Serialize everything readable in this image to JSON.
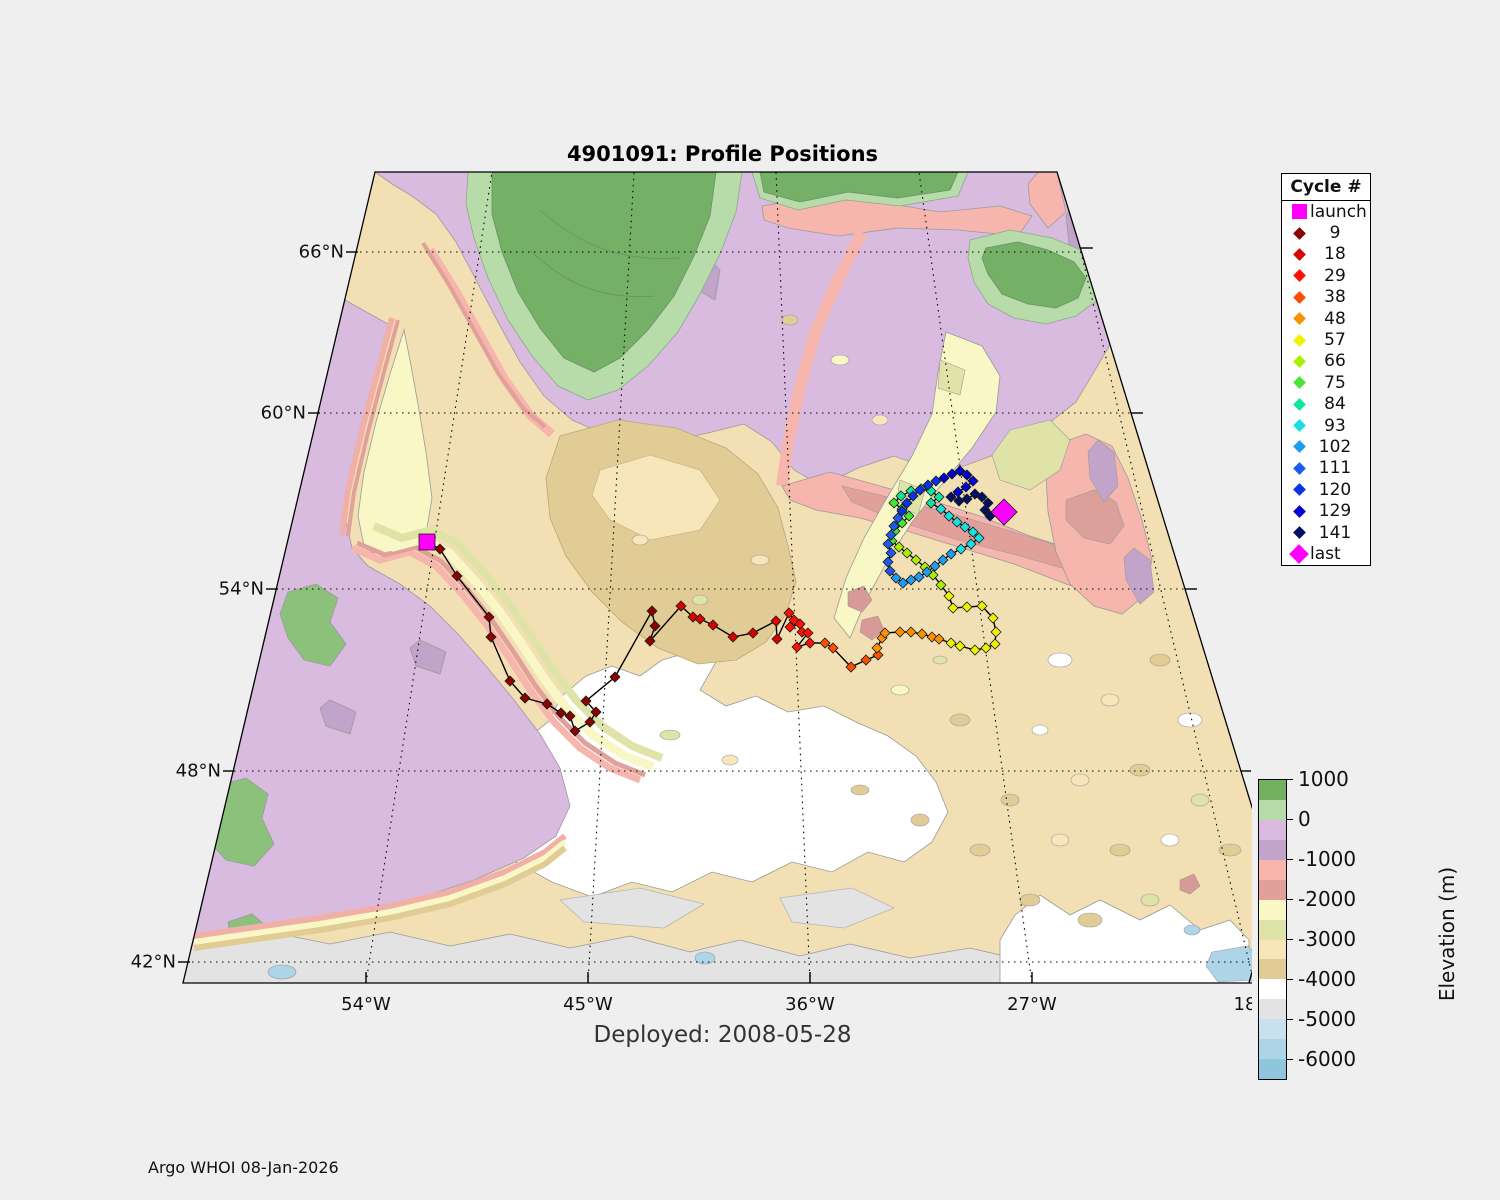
{
  "title": "4901091: Profile Positions",
  "deployed_text": "Deployed: 2008-05-28",
  "credit_text": "Argo WHOI 08-Jan-2026",
  "axes": {
    "lat_labels": [
      "66°N",
      "60°N",
      "54°N",
      "48°N",
      "42°N"
    ],
    "lon_labels": [
      "54°W",
      "45°W",
      "36°W",
      "27°W",
      "18"
    ]
  },
  "legend": {
    "title": "Cycle #",
    "entries": [
      {
        "label": "launch",
        "marker": "square",
        "color": "#ff00ff"
      },
      {
        "label": "9",
        "marker": "diamond",
        "color": "#8b0000"
      },
      {
        "label": "18",
        "marker": "diamond",
        "color": "#d80000"
      },
      {
        "label": "29",
        "marker": "diamond",
        "color": "#f81400"
      },
      {
        "label": "38",
        "marker": "diamond",
        "color": "#fa5000"
      },
      {
        "label": "48",
        "marker": "diamond",
        "color": "#fb9100"
      },
      {
        "label": "57",
        "marker": "diamond",
        "color": "#f0f000"
      },
      {
        "label": "66",
        "marker": "diamond",
        "color": "#a8f000"
      },
      {
        "label": "75",
        "marker": "diamond",
        "color": "#46e632"
      },
      {
        "label": "84",
        "marker": "diamond",
        "color": "#0ee69b"
      },
      {
        "label": "93",
        "marker": "diamond",
        "color": "#18e0e0"
      },
      {
        "label": "102",
        "marker": "diamond",
        "color": "#1e9bf5"
      },
      {
        "label": "111",
        "marker": "diamond",
        "color": "#1e5af0"
      },
      {
        "label": "120",
        "marker": "diamond",
        "color": "#0a32e6"
      },
      {
        "label": "129",
        "marker": "diamond",
        "color": "#0000d2"
      },
      {
        "label": "141",
        "marker": "diamond",
        "color": "#001064"
      },
      {
        "label": "last",
        "marker": "bigdiamond",
        "color": "#ff00ff"
      }
    ]
  },
  "colorbar": {
    "axis_label": "Elevation (m)",
    "tick_labels": [
      "1000",
      "0",
      "-1000",
      "-2000",
      "-3000",
      "-4000",
      "-5000",
      "-6000"
    ],
    "tick_values": [
      1000,
      0,
      -1000,
      -2000,
      -3000,
      -4000,
      -5000,
      -6000
    ],
    "segment_colors": [
      "#72b161",
      "#b7dcaa",
      "#d9b9e0",
      "#c2a4cb",
      "#f9b4ae",
      "#e2a09a",
      "#f9f7c5",
      "#dfe3a8",
      "#f8e6bb",
      "#e2cc96",
      "#ffffff",
      "#e3e3e3",
      "#c9e0ef",
      "#aed4e8",
      "#8fc6de"
    ]
  },
  "chart_data": {
    "type": "scatter",
    "title": "4901091: Profile Positions",
    "notes": "Argo float trajectory over bathymetry; marker color = cycle number",
    "launch": {
      "x": 427,
      "y": 542
    },
    "last": {
      "x": 1004,
      "y": 512
    },
    "groups": [
      {
        "cycle": "9",
        "color": "#8b0000",
        "points": [
          [
            440,
            549
          ],
          [
            457,
            576
          ],
          [
            489,
            617
          ],
          [
            491,
            637
          ],
          [
            510,
            681
          ],
          [
            525,
            698
          ],
          [
            547,
            704
          ],
          [
            561,
            713
          ],
          [
            570,
            716
          ],
          [
            575,
            731
          ],
          [
            590,
            722
          ],
          [
            596,
            712
          ],
          [
            586,
            701
          ],
          [
            615,
            677
          ],
          [
            652,
            611
          ],
          [
            655,
            626
          ],
          [
            650,
            641
          ]
        ]
      },
      {
        "cycle": "18",
        "color": "#d80000",
        "points": [
          [
            681,
            606
          ],
          [
            693,
            617
          ],
          [
            700,
            619
          ],
          [
            713,
            625
          ],
          [
            733,
            637
          ],
          [
            753,
            633
          ],
          [
            776,
            621
          ],
          [
            777,
            639
          ]
        ]
      },
      {
        "cycle": "29",
        "color": "#f81400",
        "points": [
          [
            789,
            613
          ],
          [
            794,
            620
          ],
          [
            790,
            627
          ],
          [
            800,
            624
          ],
          [
            802,
            632
          ],
          [
            808,
            633
          ],
          [
            797,
            647
          ],
          [
            810,
            643
          ]
        ]
      },
      {
        "cycle": "38",
        "color": "#fa5000",
        "points": [
          [
            825,
            643
          ],
          [
            833,
            648
          ],
          [
            851,
            667
          ],
          [
            866,
            660
          ],
          [
            878,
            655
          ]
        ]
      },
      {
        "cycle": "48",
        "color": "#fb9100",
        "points": [
          [
            877,
            648
          ],
          [
            882,
            638
          ],
          [
            885,
            633
          ],
          [
            900,
            632
          ],
          [
            911,
            632
          ],
          [
            922,
            634
          ],
          [
            932,
            637
          ],
          [
            939,
            639
          ]
        ]
      },
      {
        "cycle": "57",
        "color": "#f0f000",
        "points": [
          [
            951,
            643
          ],
          [
            960,
            646
          ],
          [
            975,
            650
          ],
          [
            986,
            648
          ],
          [
            995,
            644
          ],
          [
            996,
            632
          ],
          [
            993,
            618
          ],
          [
            982,
            606
          ],
          [
            967,
            607
          ],
          [
            953,
            608
          ],
          [
            949,
            596
          ]
        ]
      },
      {
        "cycle": "66",
        "color": "#a8f000",
        "points": [
          [
            941,
            585
          ],
          [
            933,
            575
          ],
          [
            925,
            567
          ],
          [
            916,
            560
          ],
          [
            907,
            553
          ],
          [
            899,
            547
          ]
        ]
      },
      {
        "cycle": "75",
        "color": "#46e632",
        "points": [
          [
            892,
            541
          ],
          [
            895,
            531
          ],
          [
            902,
            523
          ],
          [
            909,
            516
          ],
          [
            902,
            509
          ],
          [
            894,
            503
          ]
        ]
      },
      {
        "cycle": "84",
        "color": "#0ee69b",
        "points": [
          [
            901,
            496
          ],
          [
            911,
            491
          ],
          [
            921,
            489
          ],
          [
            931,
            491
          ],
          [
            939,
            497
          ],
          [
            931,
            503
          ]
        ]
      },
      {
        "cycle": "93",
        "color": "#18e0e0",
        "points": [
          [
            941,
            509
          ],
          [
            949,
            516
          ],
          [
            957,
            522
          ],
          [
            965,
            527
          ],
          [
            973,
            532
          ],
          [
            979,
            538
          ],
          [
            971,
            544
          ],
          [
            961,
            549
          ]
        ]
      },
      {
        "cycle": "102",
        "color": "#1e9bf5",
        "points": [
          [
            951,
            554
          ],
          [
            943,
            560
          ],
          [
            935,
            566
          ],
          [
            927,
            572
          ],
          [
            919,
            577
          ],
          [
            911,
            580
          ],
          [
            903,
            583
          ],
          [
            896,
            578
          ]
        ]
      },
      {
        "cycle": "111",
        "color": "#1e5af0",
        "points": [
          [
            890,
            571
          ],
          [
            888,
            562
          ],
          [
            891,
            553
          ],
          [
            888,
            544
          ],
          [
            891,
            535
          ],
          [
            894,
            526
          ],
          [
            898,
            518
          ]
        ]
      },
      {
        "cycle": "120",
        "color": "#0a32e6",
        "points": [
          [
            902,
            511
          ],
          [
            907,
            503
          ],
          [
            913,
            496
          ],
          [
            920,
            490
          ],
          [
            928,
            485
          ],
          [
            936,
            481
          ]
        ]
      },
      {
        "cycle": "129",
        "color": "#0000d2",
        "points": [
          [
            944,
            478
          ],
          [
            952,
            474
          ],
          [
            960,
            471
          ],
          [
            967,
            475
          ],
          [
            973,
            481
          ],
          [
            966,
            487
          ],
          [
            958,
            492
          ]
        ]
      },
      {
        "cycle": "141",
        "color": "#001064",
        "points": [
          [
            951,
            497
          ],
          [
            959,
            501
          ],
          [
            967,
            499
          ],
          [
            975,
            494
          ],
          [
            982,
            497
          ],
          [
            988,
            503
          ],
          [
            985,
            510
          ],
          [
            990,
            516
          ]
        ]
      }
    ]
  }
}
